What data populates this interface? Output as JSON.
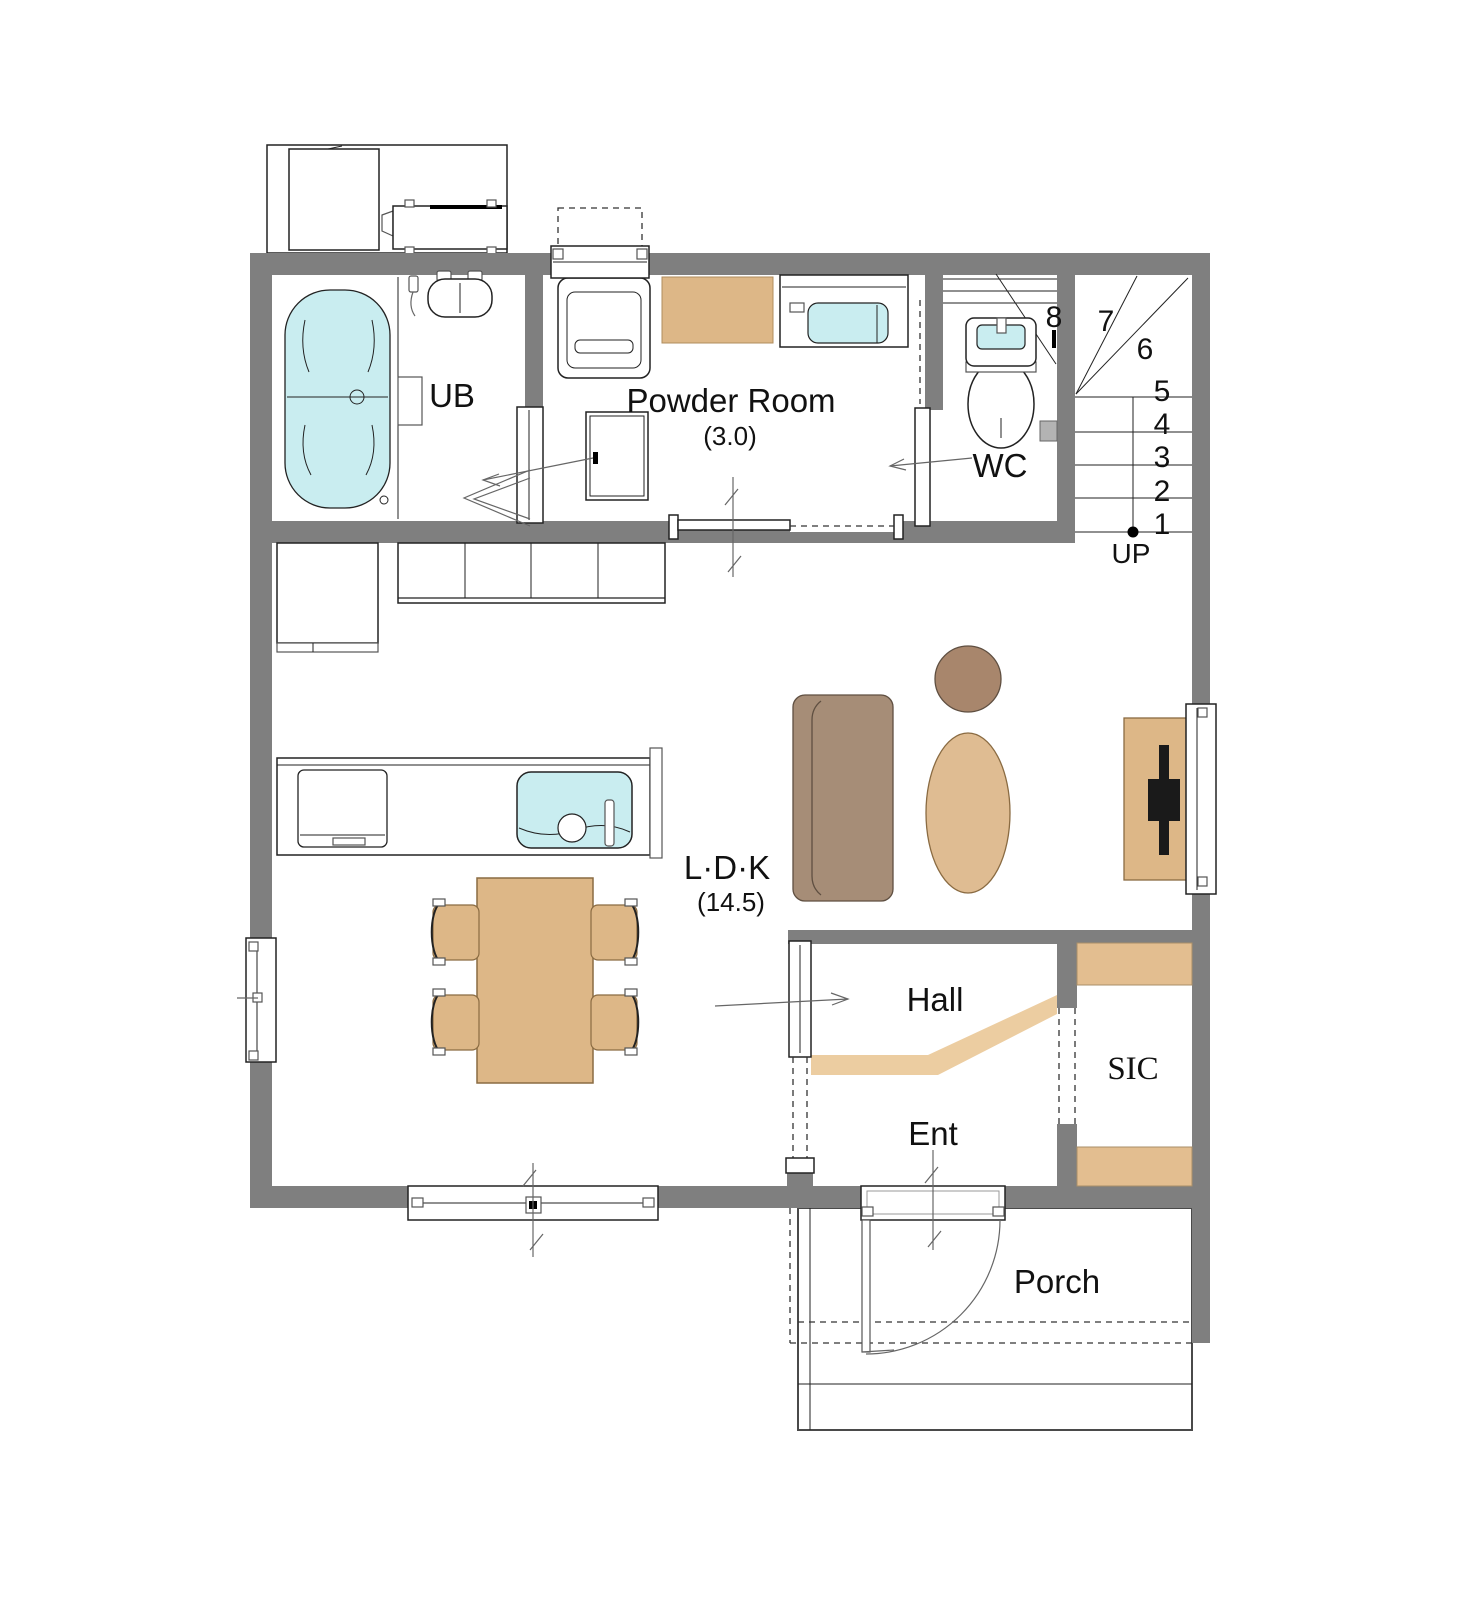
{
  "plan_title": "1F floor plan",
  "colors": {
    "wall": "#7f7f7f",
    "line": "#222222",
    "annot": "#666666",
    "water": "#c9edf0",
    "wood": "#ddb787",
    "wood_light": "#ecce a1",
    "kamachi": "#eccda1",
    "shelf": "#e3be90",
    "rug": "#dfbc92",
    "sofa": "#a68d77",
    "side_table": "#a8866c",
    "tv": "#1a1a1a",
    "holder": "#b3b3b3"
  },
  "rooms": {
    "ub": {
      "label": "UB"
    },
    "powder": {
      "label": "Powder Room",
      "size": "(3.0)"
    },
    "wc": {
      "label": "WC"
    },
    "ldk": {
      "label": "L·D·K",
      "size": "(14.5)"
    },
    "hall": {
      "label": "Hall"
    },
    "ent": {
      "label": "Ent"
    },
    "sic": {
      "label": "SIC"
    },
    "porch": {
      "label": "Porch"
    }
  },
  "stairs": {
    "up": "UP",
    "steps": [
      "1",
      "2",
      "3",
      "4",
      "5",
      "6",
      "7",
      "8"
    ]
  }
}
